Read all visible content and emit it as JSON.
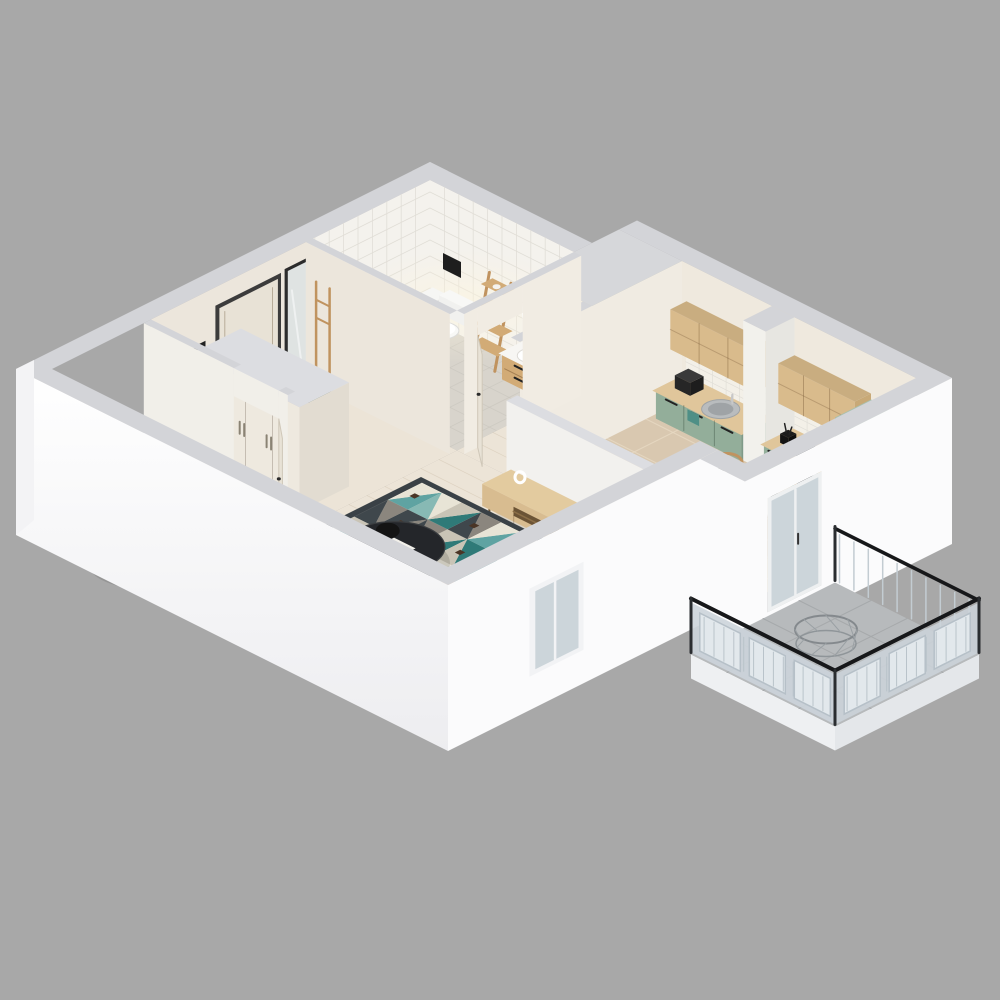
{
  "scene": {
    "kind": "isometric-apartment-floor-plan-render",
    "rooms": [
      "bathroom",
      "hallway",
      "kitchen",
      "dining-area",
      "living-room",
      "balcony"
    ],
    "furniture": [
      "toilet",
      "ladder-shelf",
      "round-led-mirror",
      "vanity-sink",
      "shower-set",
      "entry-door",
      "wall-mirror",
      "coat-rack",
      "bench",
      "wardrobe",
      "interior-door",
      "upper-cabinets",
      "base-cabinets",
      "kitchen-sink",
      "coffee-machine",
      "cooktop",
      "oven",
      "tall-cabinet",
      "dining-table",
      "dining-chairs",
      "place-settings",
      "half-wall",
      "tv-stand",
      "decor-vase",
      "floor-plant",
      "geometric-rug",
      "coffee-table",
      "sofa",
      "pillows",
      "floor-lamp",
      "armchair",
      "window",
      "balcony-door",
      "balcony-railing",
      "wire-chair"
    ]
  },
  "palette": {
    "background": "#a8a8a8",
    "wall_top": "#d3d4d8",
    "wall_top_light": "#dcdde1",
    "wall_face_white": "#fbfbfc",
    "wall_face_bright": "#ffffff",
    "wall_interior_cream": "#ece6dc",
    "wall_interior_light": "#f1ece3",
    "tile_wall": "#f4f2ed",
    "tile_line": "#e1ded7",
    "backsplash": "#f3f0e8",
    "bathroom_floor": "#d8d4cc",
    "wood_floor": "#ece4d7",
    "plank_line": "#d4c7b2",
    "kitchen_tile": "#d9c8b0",
    "kitchen_tile_line": "#e7d9c3",
    "balcony_floor": "#b7babc",
    "balcony_tile_line": "#a6a9ab",
    "cabinet_wood": "#d9bb8c",
    "cabinet_wood_dark": "#c8a977",
    "counter_wood": "#e0c69b",
    "green_top": "#a9c0ae",
    "green_front": "#93ae9a",
    "green_side": "#7f9a88",
    "steel": "#b9bcbe",
    "steel_dark": "#9fa3a6",
    "appliance_black": "#17181a",
    "door_cream": "#e8e2d6",
    "door_trim": "#3c3c3c",
    "mirror_glass": "#dfe3e2",
    "wardrobe_front": "#eee9df",
    "wardrobe_side": "#e2dcd1",
    "rug_border": "#3a4146",
    "rug_base": "#e8e4d6",
    "rug_teal": "#5fa3a2",
    "rug_teal_dark": "#2f7a78",
    "rug_teal_light": "#87b9b4",
    "rug_gray": "#8b867e",
    "rug_slate": "#3f474c",
    "rug_sand": "#c9c4b6",
    "rug_stripe": "#4a3526",
    "sofa_base": "#bcb9b3",
    "sofa_front": "#b3b0aa",
    "sofa_side": "#aaa7a1",
    "sofa_top": "#c6c3bd",
    "sofa_cushion": "#cdcac4",
    "pillow_green": "#a9bfa2",
    "pillow_light": "#c2cdbb",
    "armchair_tan": "#d99e70",
    "armchair_light": "#e2ab7e",
    "armchair_dark": "#c48b5e",
    "table_white": "#f4f2ec",
    "chair_wood": "#c0935f",
    "charger_wood": "#c79d5e",
    "seat_gray": "#6e6e6c",
    "plate_white": "#faf9f5",
    "railing_frame": "#b6c0c8",
    "railing_panel": "#e2e8ec",
    "railing_glassy": "#ccd4da",
    "handrail_black": "#17181a",
    "glass": "#ccd5da",
    "plant_green": "#4c7c4a",
    "plant_green_light": "#62985c",
    "plant_green_dark": "#3e6b40",
    "bench_green": "#7f9873",
    "towel_teal": "#4e8f86",
    "slab_white": "#eef0f2"
  }
}
